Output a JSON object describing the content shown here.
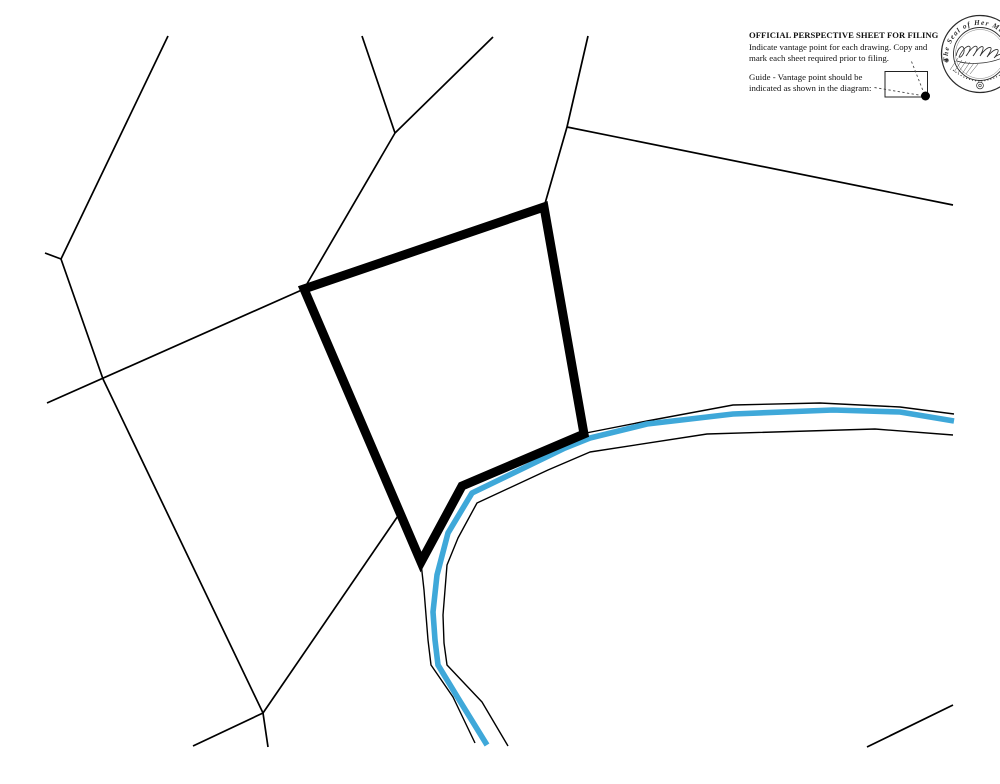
{
  "header": {
    "title": "OFFICIAL PERSPECTIVE SHEET FOR FILING",
    "instructions": [
      "Indicate vantage point for each drawing. Copy and",
      "mark each sheet required prior to filing."
    ],
    "guide": [
      "Guide - Vantage point should be",
      "indicated as shown in the diagram:"
    ]
  },
  "seal": {
    "arc_text": "The Seal of Her Maj",
    "mark": "⊕"
  },
  "map": {
    "ink": "#000000",
    "river_color": "#3FA8D9",
    "parcel_lines": [
      {
        "name": "north-ridge",
        "points": [
          [
            168,
            36
          ],
          [
            61,
            259
          ]
        ]
      },
      {
        "name": "ridge-spur",
        "points": [
          [
            61,
            259
          ],
          [
            45,
            253
          ]
        ]
      },
      {
        "name": "west-boundary",
        "points": [
          [
            61,
            259
          ],
          [
            103,
            379
          ],
          [
            263,
            713
          ],
          [
            268,
            747
          ]
        ]
      },
      {
        "name": "southwest-diagonal",
        "points": [
          [
            47,
            403
          ],
          [
            304,
            289
          ]
        ]
      },
      {
        "name": "northwest-connector",
        "points": [
          [
            304,
            289
          ],
          [
            395,
            133
          ]
        ]
      },
      {
        "name": "north-fork-west",
        "points": [
          [
            395,
            133
          ],
          [
            362,
            36
          ]
        ]
      },
      {
        "name": "north-fork-east",
        "points": [
          [
            395,
            133
          ],
          [
            493,
            37
          ]
        ]
      },
      {
        "name": "north-connector",
        "points": [
          [
            588,
            36
          ],
          [
            567,
            127
          ],
          [
            544,
            207
          ]
        ]
      },
      {
        "name": "northeast-long-line",
        "points": [
          [
            567,
            127
          ],
          [
            953,
            205
          ]
        ]
      },
      {
        "name": "south-connector",
        "points": [
          [
            263,
            713
          ],
          [
            400,
            513
          ]
        ]
      },
      {
        "name": "south-tail",
        "points": [
          [
            263,
            713
          ],
          [
            193,
            746
          ]
        ]
      },
      {
        "name": "southeast-stub",
        "points": [
          [
            867,
            747
          ],
          [
            953,
            705
          ]
        ]
      }
    ],
    "boundary": {
      "name": "bold-parcel-boundary",
      "closed": true,
      "stroke_width": 9,
      "points": [
        [
          544,
          207
        ],
        [
          304,
          289
        ],
        [
          421,
          562
        ],
        [
          462,
          486
        ],
        [
          584,
          434
        ]
      ]
    },
    "river": {
      "stream_width": 5.6,
      "stream": [
        [
          954,
          421
        ],
        [
          900,
          412
        ],
        [
          833,
          410
        ],
        [
          733,
          414
        ],
        [
          647,
          424
        ],
        [
          590,
          438
        ],
        [
          565,
          448
        ],
        [
          472,
          493
        ],
        [
          448,
          533
        ],
        [
          437,
          575
        ],
        [
          433,
          612
        ],
        [
          435,
          640
        ],
        [
          438,
          665
        ],
        [
          458,
          698
        ],
        [
          487,
          745
        ]
      ],
      "banks": [
        {
          "name": "north-bank",
          "points": [
            [
              954,
              414
            ],
            [
              900,
              407
            ],
            [
              820,
              403
            ],
            [
              733,
              405
            ],
            [
              647,
              421
            ],
            [
              586,
              433
            ]
          ]
        },
        {
          "name": "south-bank",
          "points": [
            [
              953,
              435
            ],
            [
              875,
              429
            ],
            [
              707,
              434
            ],
            [
              590,
              452
            ],
            [
              548,
              470
            ],
            [
              477,
              503
            ],
            [
              458,
              538
            ],
            [
              447,
              565
            ],
            [
              443,
              615
            ],
            [
              444,
              643
            ],
            [
              447,
              665
            ],
            [
              482,
              702
            ],
            [
              508,
              746
            ]
          ]
        },
        {
          "name": "west-bank",
          "points": [
            [
              421,
              563
            ],
            [
              424,
              590
            ],
            [
              426,
              615
            ],
            [
              428,
              640
            ],
            [
              431,
              665
            ],
            [
              453,
              697
            ],
            [
              475,
              743
            ]
          ]
        }
      ]
    },
    "vantage_guide": {
      "rect": [
        885,
        71.5,
        42.5,
        25.5
      ],
      "dot": {
        "cx": 925.5,
        "cy": 96,
        "r": 4.5
      },
      "dashes": [
        [
          [
            911.5,
            61.5
          ],
          [
            924.5,
            94.5
          ]
        ],
        [
          [
            874.5,
            87.5
          ],
          [
            921.5,
            95.5
          ]
        ]
      ]
    }
  }
}
